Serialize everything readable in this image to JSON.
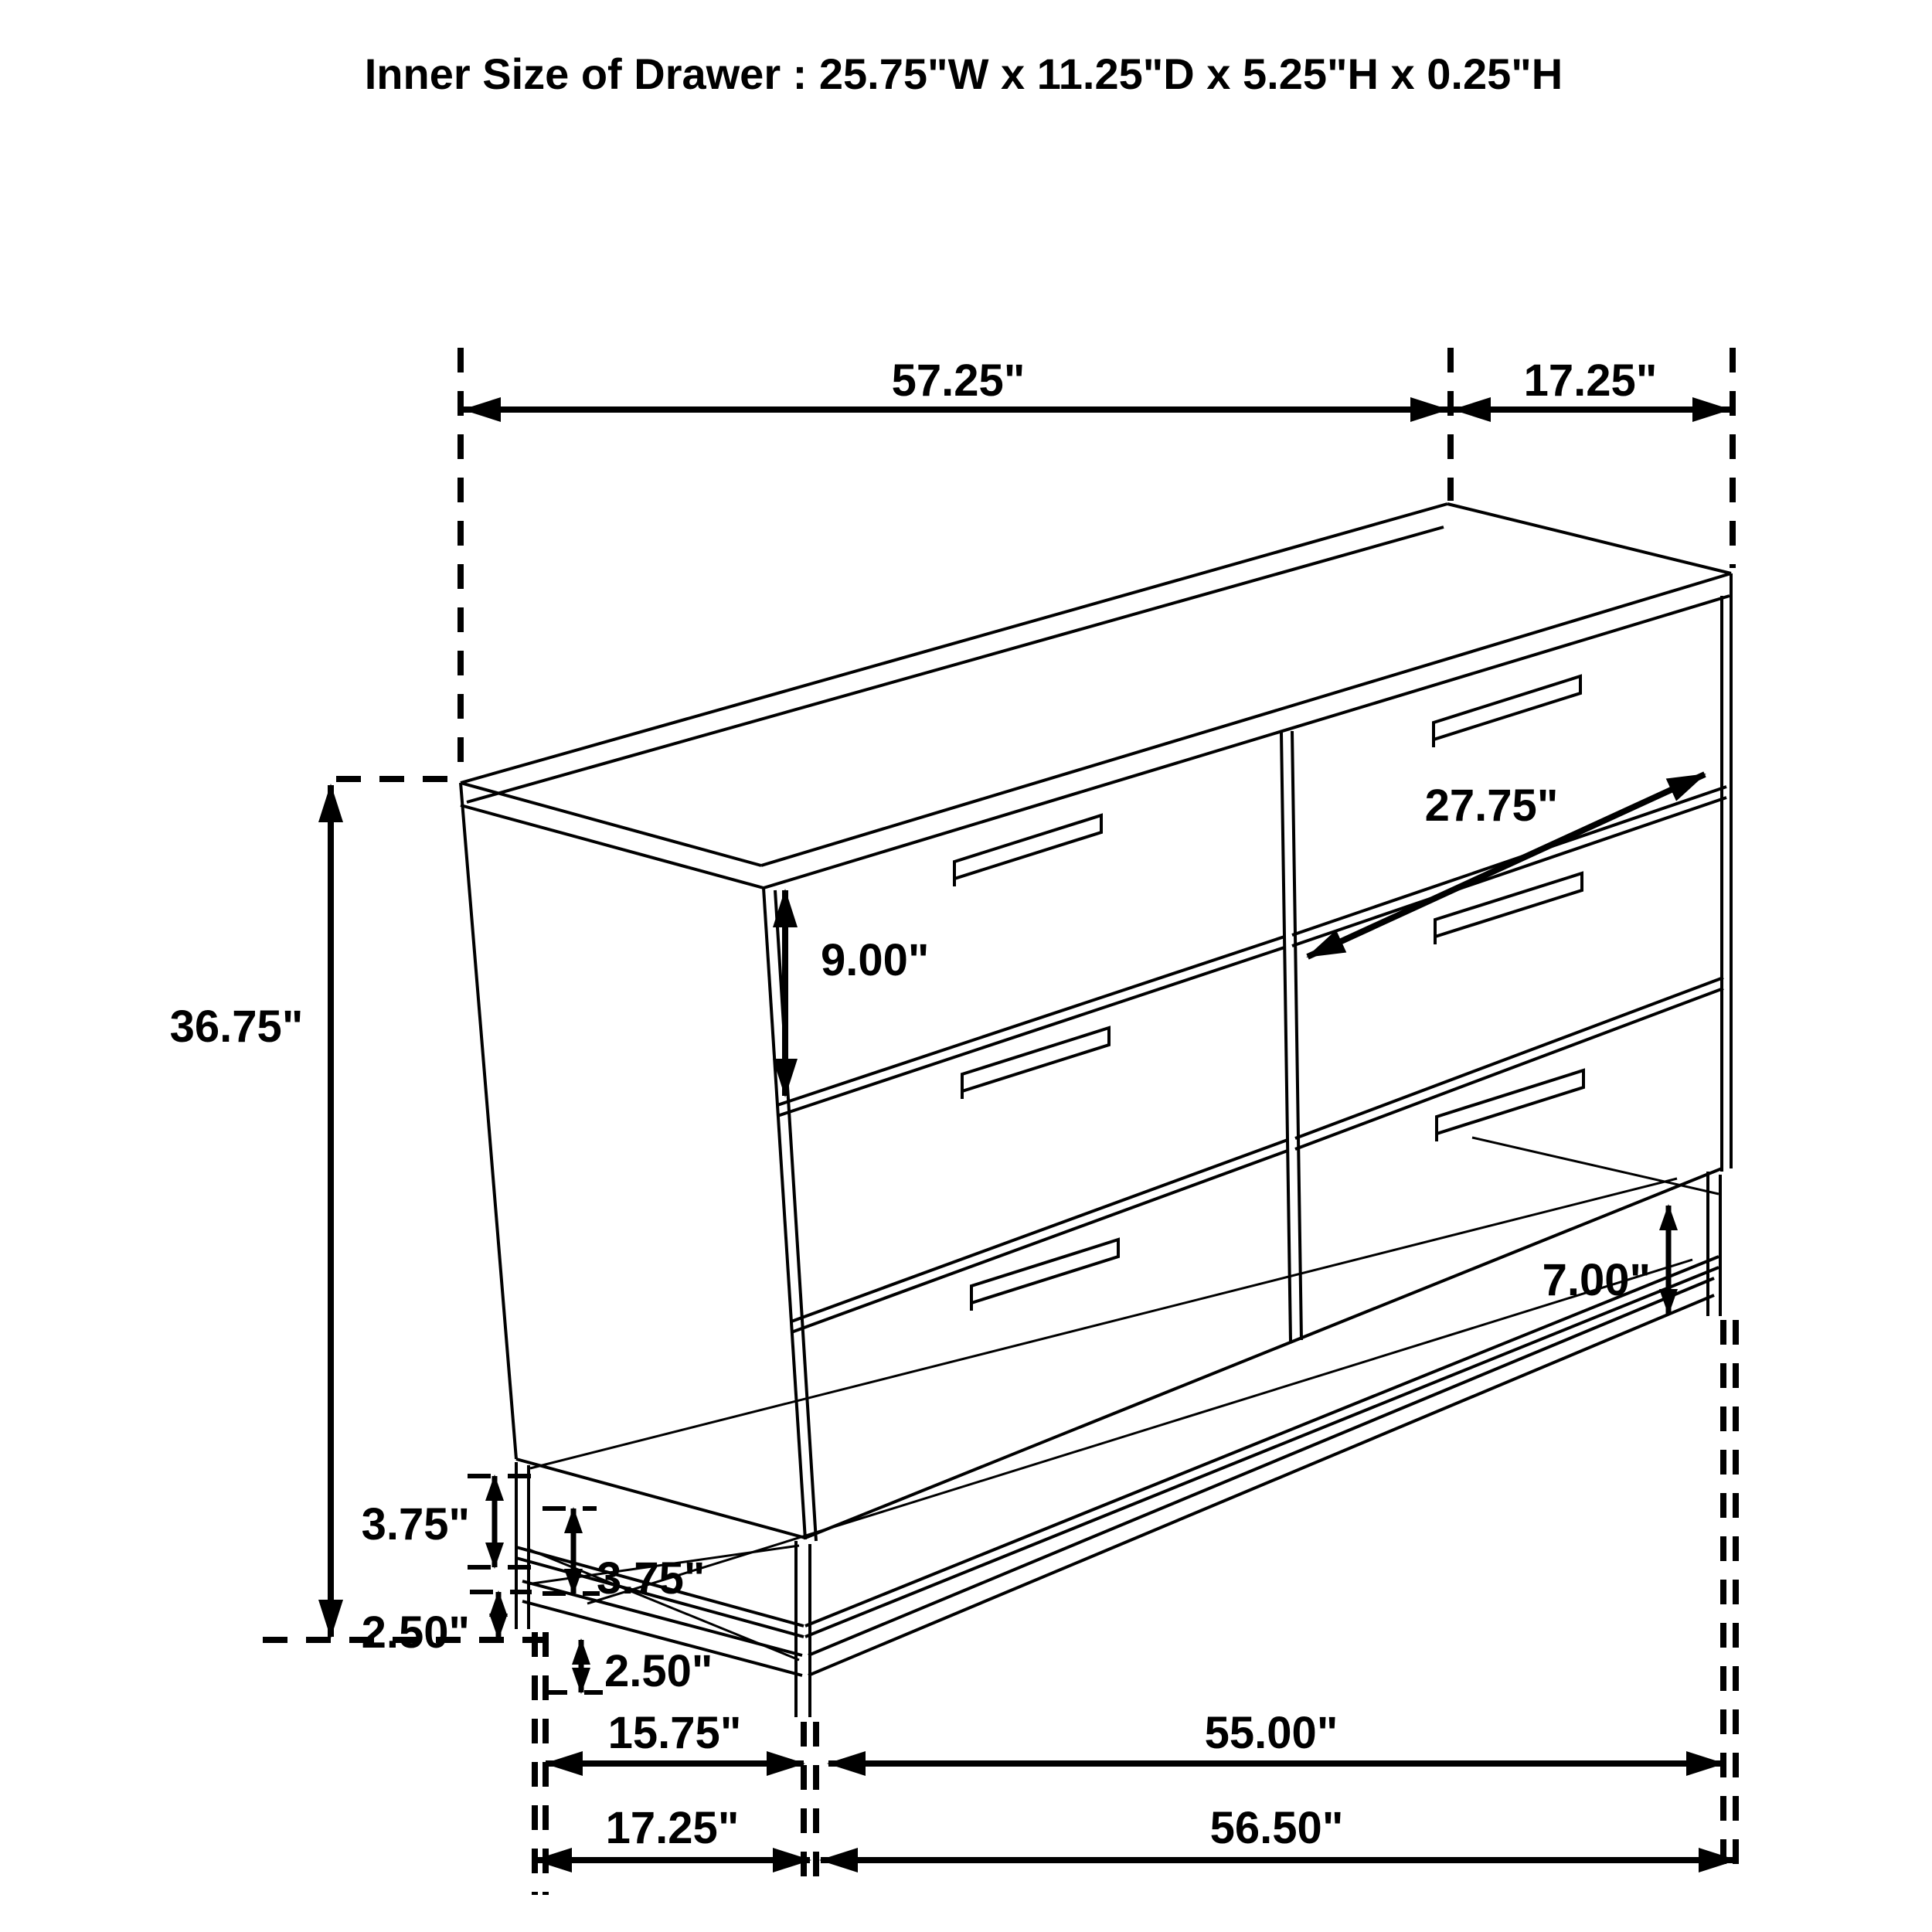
{
  "title": "Inner Size of Drawer : 25.75\"W x 11.25\"D x 5.25\"H x 0.25\"H",
  "dims": {
    "top_width": "57.25\"",
    "top_depth": "17.25\"",
    "drawer_diagonal": "27.75\"",
    "top_drawer_height": "9.00\"",
    "overall_height": "36.75\"",
    "leg_frame_height": "7.00\"",
    "frame_rail_side": "3.75\"",
    "frame_rail_front": "3.75\"",
    "leg_clearance_side": "2.50\"",
    "leg_clearance_front": "2.50\"",
    "base_depth_inner": "15.75\"",
    "base_width_inner": "55.00\"",
    "base_depth_outer": "17.25\"",
    "base_width_outer": "56.50\""
  },
  "colors": {
    "line": "#000000",
    "text": "#000000",
    "background": "#ffffff"
  }
}
